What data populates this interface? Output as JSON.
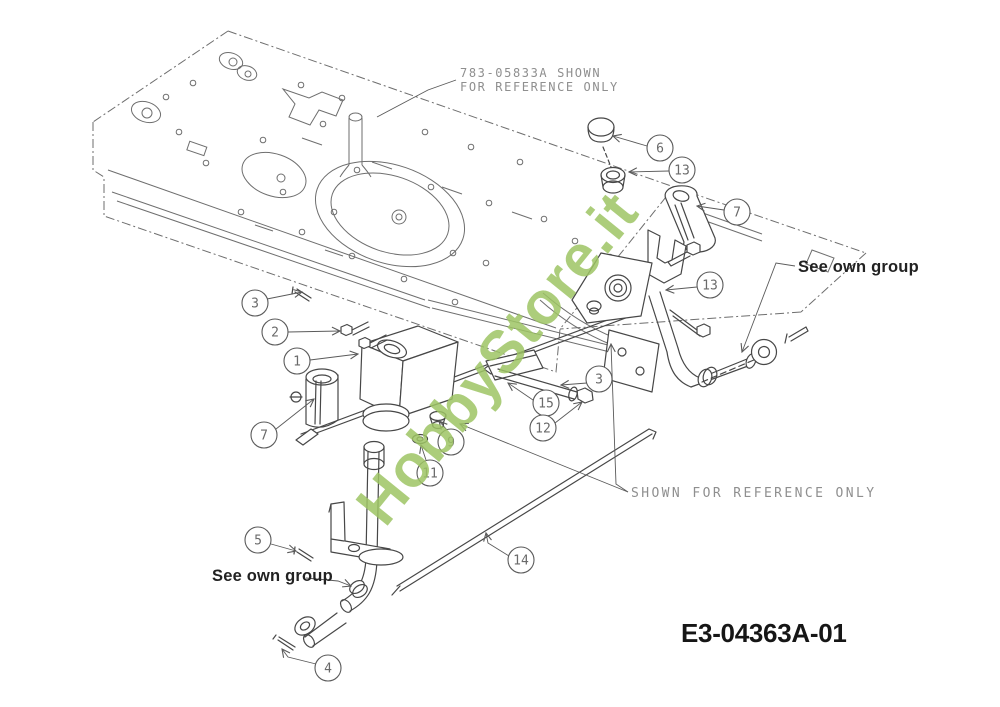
{
  "title_block": {
    "drawing_number": "E3-04363A-01"
  },
  "notes": {
    "top_reference": {
      "line1": "783-05833A SHOWN",
      "line2": "FOR REFERENCE ONLY"
    },
    "mid_reference": "SHOWN FOR REFERENCE ONLY",
    "see_own_group_right": "See own group",
    "see_own_group_left": "See own group"
  },
  "watermark": "HobbyStore.it",
  "colors": {
    "part_line": "#474747",
    "frame_line": "#6e6e6e",
    "leader_line": "#5a5a5a",
    "note_gray": "#8f8f8f",
    "text_dark": "#1c1c1c",
    "watermark_green": "#9ec464",
    "background": "#ffffff"
  },
  "callouts": [
    {
      "label": "6",
      "cx": 660,
      "cy": 148,
      "leader": [
        [
          647,
          146
        ],
        [
          613,
          136
        ]
      ]
    },
    {
      "label": "13",
      "cx": 682,
      "cy": 170,
      "leader": [
        [
          669,
          171
        ],
        [
          629,
          172
        ]
      ]
    },
    {
      "label": "7",
      "cx": 737,
      "cy": 212,
      "leader": [
        [
          724,
          210
        ],
        [
          697,
          206
        ]
      ]
    },
    {
      "label": "13",
      "cx": 710,
      "cy": 285,
      "leader": [
        [
          697,
          287
        ],
        [
          666,
          290
        ]
      ]
    },
    {
      "label": "3",
      "cx": 255,
      "cy": 303,
      "leader": [
        [
          267,
          299
        ],
        [
          302,
          292
        ]
      ]
    },
    {
      "label": "2",
      "cx": 275,
      "cy": 332,
      "leader": [
        [
          288,
          332
        ],
        [
          340,
          331
        ]
      ]
    },
    {
      "label": "1",
      "cx": 297,
      "cy": 361,
      "leader": [
        [
          310,
          360
        ],
        [
          358,
          354
        ]
      ]
    },
    {
      "label": "3",
      "cx": 599,
      "cy": 379,
      "leader": [
        [
          587,
          383
        ],
        [
          561,
          385
        ]
      ]
    },
    {
      "label": "15",
      "cx": 546,
      "cy": 403,
      "leader": [
        [
          533,
          400
        ],
        [
          508,
          383
        ]
      ]
    },
    {
      "label": "12",
      "cx": 543,
      "cy": 428,
      "leader": [
        [
          555,
          423
        ],
        [
          582,
          402
        ]
      ]
    },
    {
      "label": "9",
      "cx": 451,
      "cy": 442,
      "leader": [
        [
          447,
          430
        ],
        [
          439,
          421
        ]
      ]
    },
    {
      "label": "11",
      "cx": 430,
      "cy": 473,
      "leader": [
        [
          426,
          460
        ],
        [
          421,
          445
        ]
      ]
    },
    {
      "label": "7",
      "cx": 264,
      "cy": 435,
      "leader": [
        [
          276,
          429
        ],
        [
          314,
          399
        ]
      ]
    },
    {
      "label": "5",
      "cx": 258,
      "cy": 540,
      "leader": [
        [
          271,
          544
        ],
        [
          296,
          551
        ]
      ]
    },
    {
      "label": "14",
      "cx": 521,
      "cy": 560,
      "leader": [
        [
          509,
          556
        ],
        [
          488,
          543
        ],
        [
          486,
          533
        ]
      ]
    },
    {
      "label": "4",
      "cx": 328,
      "cy": 668,
      "leader": [
        [
          316,
          664
        ],
        [
          288,
          657
        ],
        [
          282,
          649
        ]
      ]
    }
  ],
  "leaders": [
    {
      "name": "top-reference-leader",
      "points": [
        [
          456,
          80
        ],
        [
          428,
          90
        ],
        [
          377,
          117
        ]
      ],
      "arrow": false
    },
    {
      "name": "mid-reference-leader-vertical",
      "points": [
        [
          628,
          492
        ],
        [
          616,
          484
        ],
        [
          611,
          344
        ]
      ],
      "arrow": true
    },
    {
      "name": "mid-reference-leader-diagonal",
      "points": [
        [
          628,
          492
        ],
        [
          460,
          424
        ]
      ],
      "arrow": true
    },
    {
      "name": "see-own-group-right-leader",
      "points": [
        [
          795,
          266
        ],
        [
          776,
          263
        ],
        [
          742,
          352
        ]
      ],
      "arrow": true
    },
    {
      "name": "see-own-group-left-leader",
      "points": [
        [
          306,
          578
        ],
        [
          338,
          581
        ],
        [
          351,
          586
        ]
      ],
      "arrow": true
    }
  ]
}
